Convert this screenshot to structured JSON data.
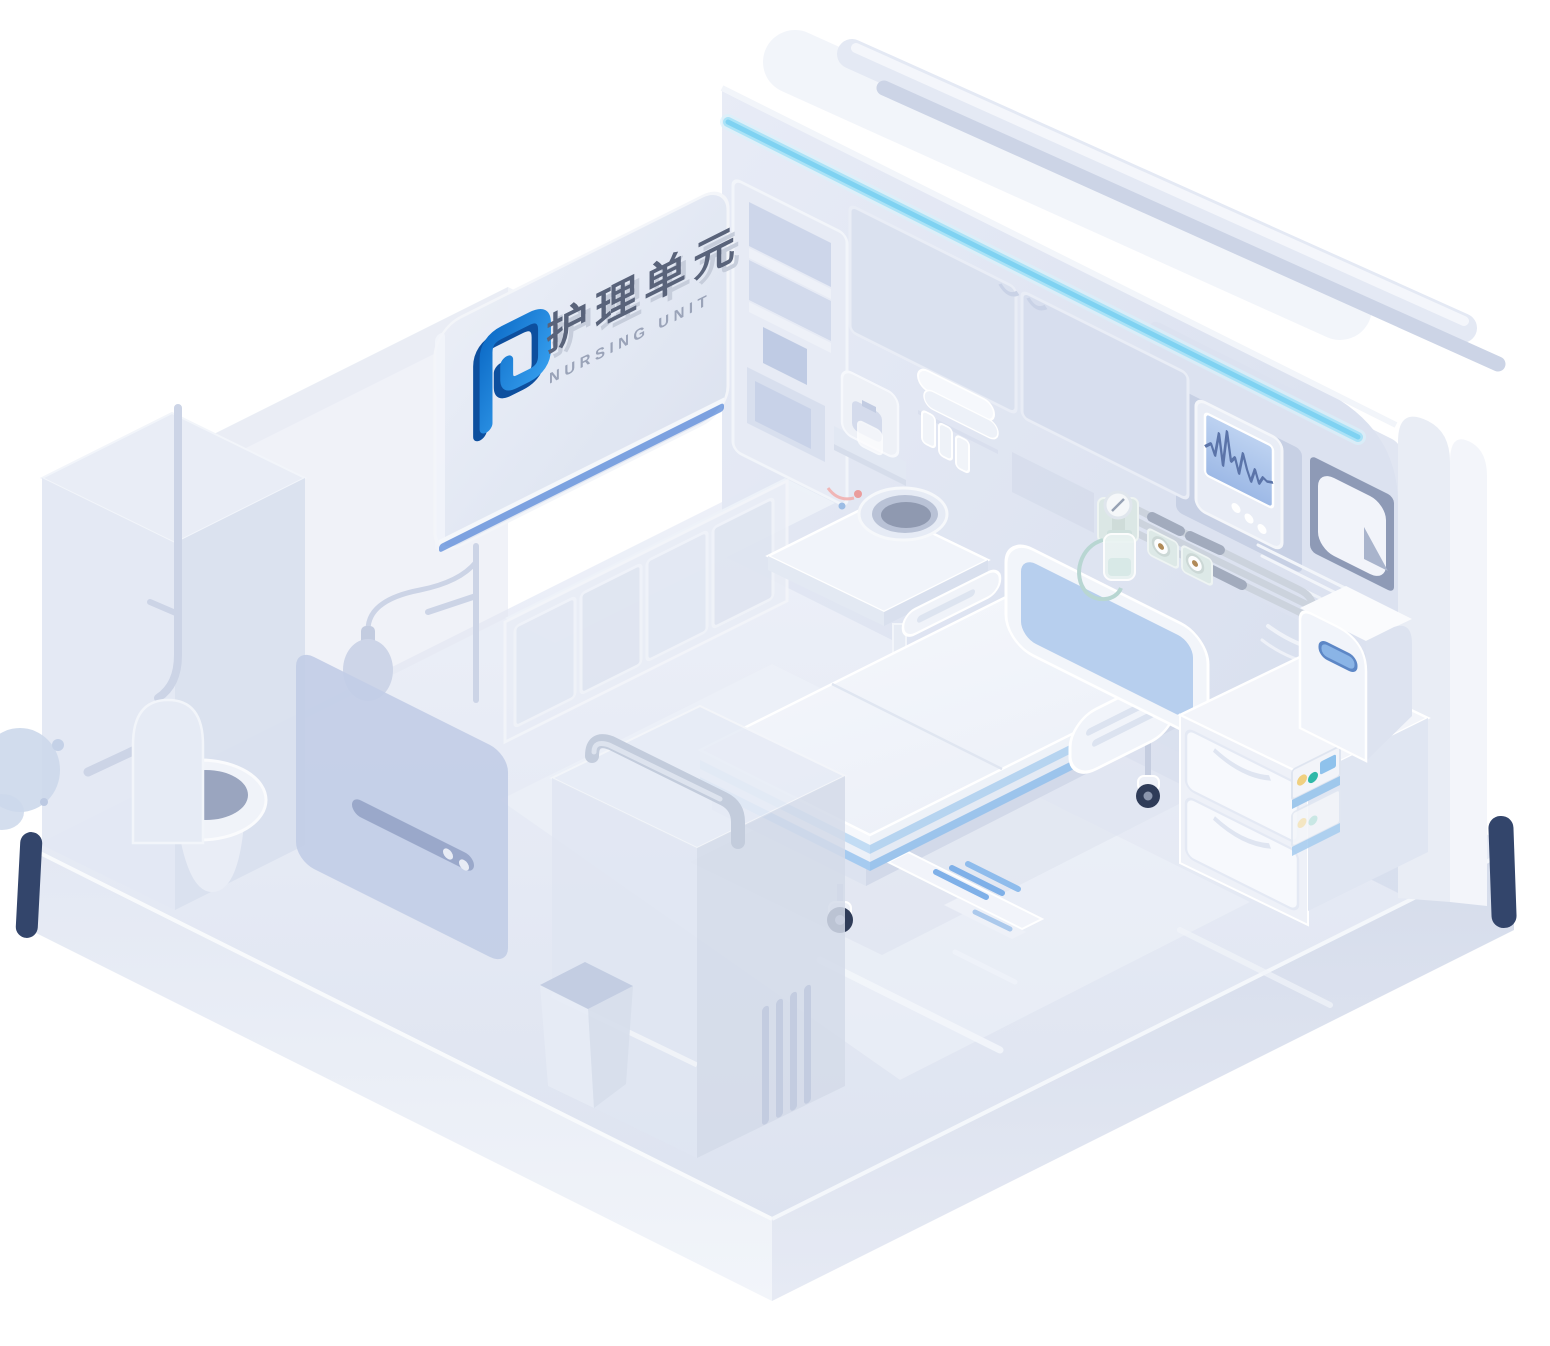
{
  "background": "#ffffff",
  "sign": {
    "title_zh": "护理单元",
    "subtitle_en": "NURSING UNIT",
    "logo_icon": "nursing-unit-logo"
  },
  "colors": {
    "brand_blue": "#1f7de2",
    "brand_blue_dark": "#0d4f9e",
    "led_cyan": "#7fd2f2",
    "accent_navy": "#33456b",
    "wall": "#dfe5f1",
    "floor": "#e7ebf5",
    "door_panel_blue": "#c2cde6",
    "headboard_blue": "#b7cfee",
    "handle_blue": "#8ab4e6",
    "screen_blue": "#a9c3ea",
    "waveform_blue": "#5b74a9",
    "bed_stripe_blue": "#7fb0e8",
    "teal_accent": "#2fb8a8",
    "yellow_accent": "#f0d080"
  },
  "monitor": {
    "waveform_points": "0,34 6,28 10,38 14,14 18,44 22,8 26,36 30,30 34,44 38,22 42,36 46,46 50,32 54,44 58,36 62,38 68,36",
    "button_count": 3
  },
  "scene_objects": [
    "sign-board",
    "hospital-bed",
    "patient-monitor",
    "bedside-cabinet",
    "mini-fridge",
    "infusion-pump-stack",
    "oxygen-flowmeter",
    "gas-outlets",
    "gas-pipes",
    "sink-counter",
    "water-dispenser",
    "upper-cabinets",
    "shelf-unit",
    "led-strip",
    "curtain-rail",
    "wardrobe",
    "trash-bin",
    "toilet",
    "shower-set",
    "bathroom-door",
    "grab-bar"
  ]
}
